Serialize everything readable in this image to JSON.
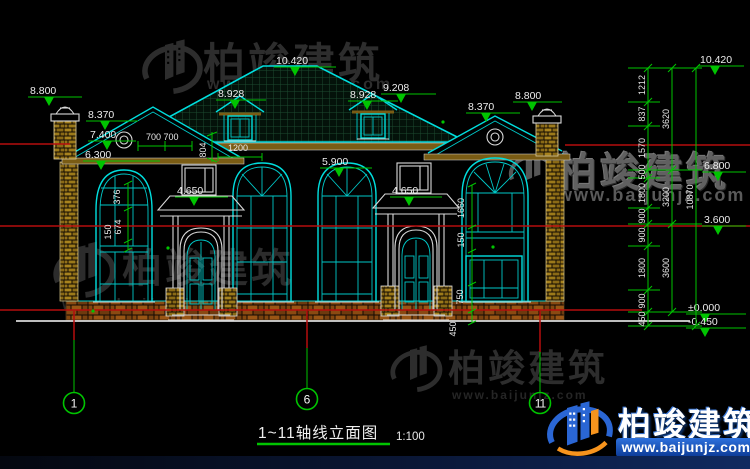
{
  "title": {
    "text": "1~11轴线立面图",
    "scale": "1:100"
  },
  "axes": {
    "a1": "1",
    "a6": "6",
    "a11": "11"
  },
  "watermark": {
    "brand": "柏竣建筑",
    "url": "www.baijunjz.com"
  },
  "colors": {
    "line_cyan": "#00dede",
    "dim_green": "#00c400",
    "ref_red": "#b50d0d",
    "logo_blue": "#2a66d4",
    "logo_orange": "#f7941d"
  },
  "dims": {
    "left": [
      "8.800",
      "8.370",
      "7.400",
      "6.300"
    ],
    "top": {
      "peak": "10.420",
      "dormer_left": "8.928",
      "dormer_right": "8.928",
      "ridge_right": "9.208",
      "gable_right": "8.370",
      "chimney_right": "8.800"
    },
    "mid": {
      "eave": "5.900",
      "porch_left": "4.650",
      "porch_right": "4.650"
    },
    "small": {
      "s700": "700 700",
      "s804": "804",
      "s1200": "1200",
      "s376": "376",
      "s674": "674",
      "s150a": "150",
      "s1660": "1660",
      "s150b": "150",
      "s750": "750",
      "s450": "450"
    },
    "right_levels": [
      "10.420",
      "6.800",
      "3.600",
      "±0.000",
      "-0.450"
    ],
    "chain_inner": [
      "1212",
      "837",
      "1570",
      "500",
      "1800",
      "900",
      "900",
      "1800",
      "900",
      "450"
    ],
    "chain_mid": [
      "3620",
      "3200",
      "3600"
    ],
    "chain_outer": [
      "10870"
    ]
  }
}
